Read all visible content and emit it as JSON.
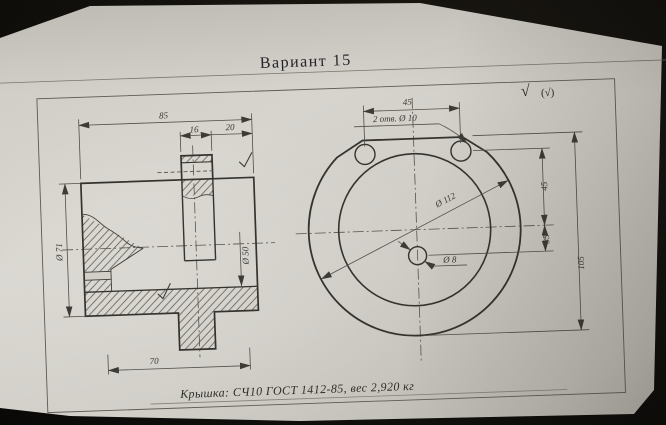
{
  "photo": {
    "page_title": "Вариант 15",
    "caption": "Крышка: СЧ10 ГОСТ 1412-85, вес 2,920 кг",
    "roughness_primary": "√",
    "roughness_secondary": "(√)"
  },
  "left_view": {
    "dim_total_width": "85",
    "dim_boss_width": "16",
    "dim_right_offset": "20",
    "dim_outer_diameter": "Ø 71",
    "dim_bore_diameter": "Ø 50",
    "dim_bottom_width": "70"
  },
  "right_view": {
    "dim_holes_span": "45",
    "holes_note": "2 отв. Ø 10",
    "dim_flange_diameter": "Ø 112",
    "dim_center_hole": "Ø 8",
    "dim_upper_height": "45",
    "dim_lower_height": "35",
    "dim_total_height": "105"
  },
  "colors": {
    "paper": "#d4d1ca",
    "ink": "#35342f",
    "background": "#14120e"
  }
}
